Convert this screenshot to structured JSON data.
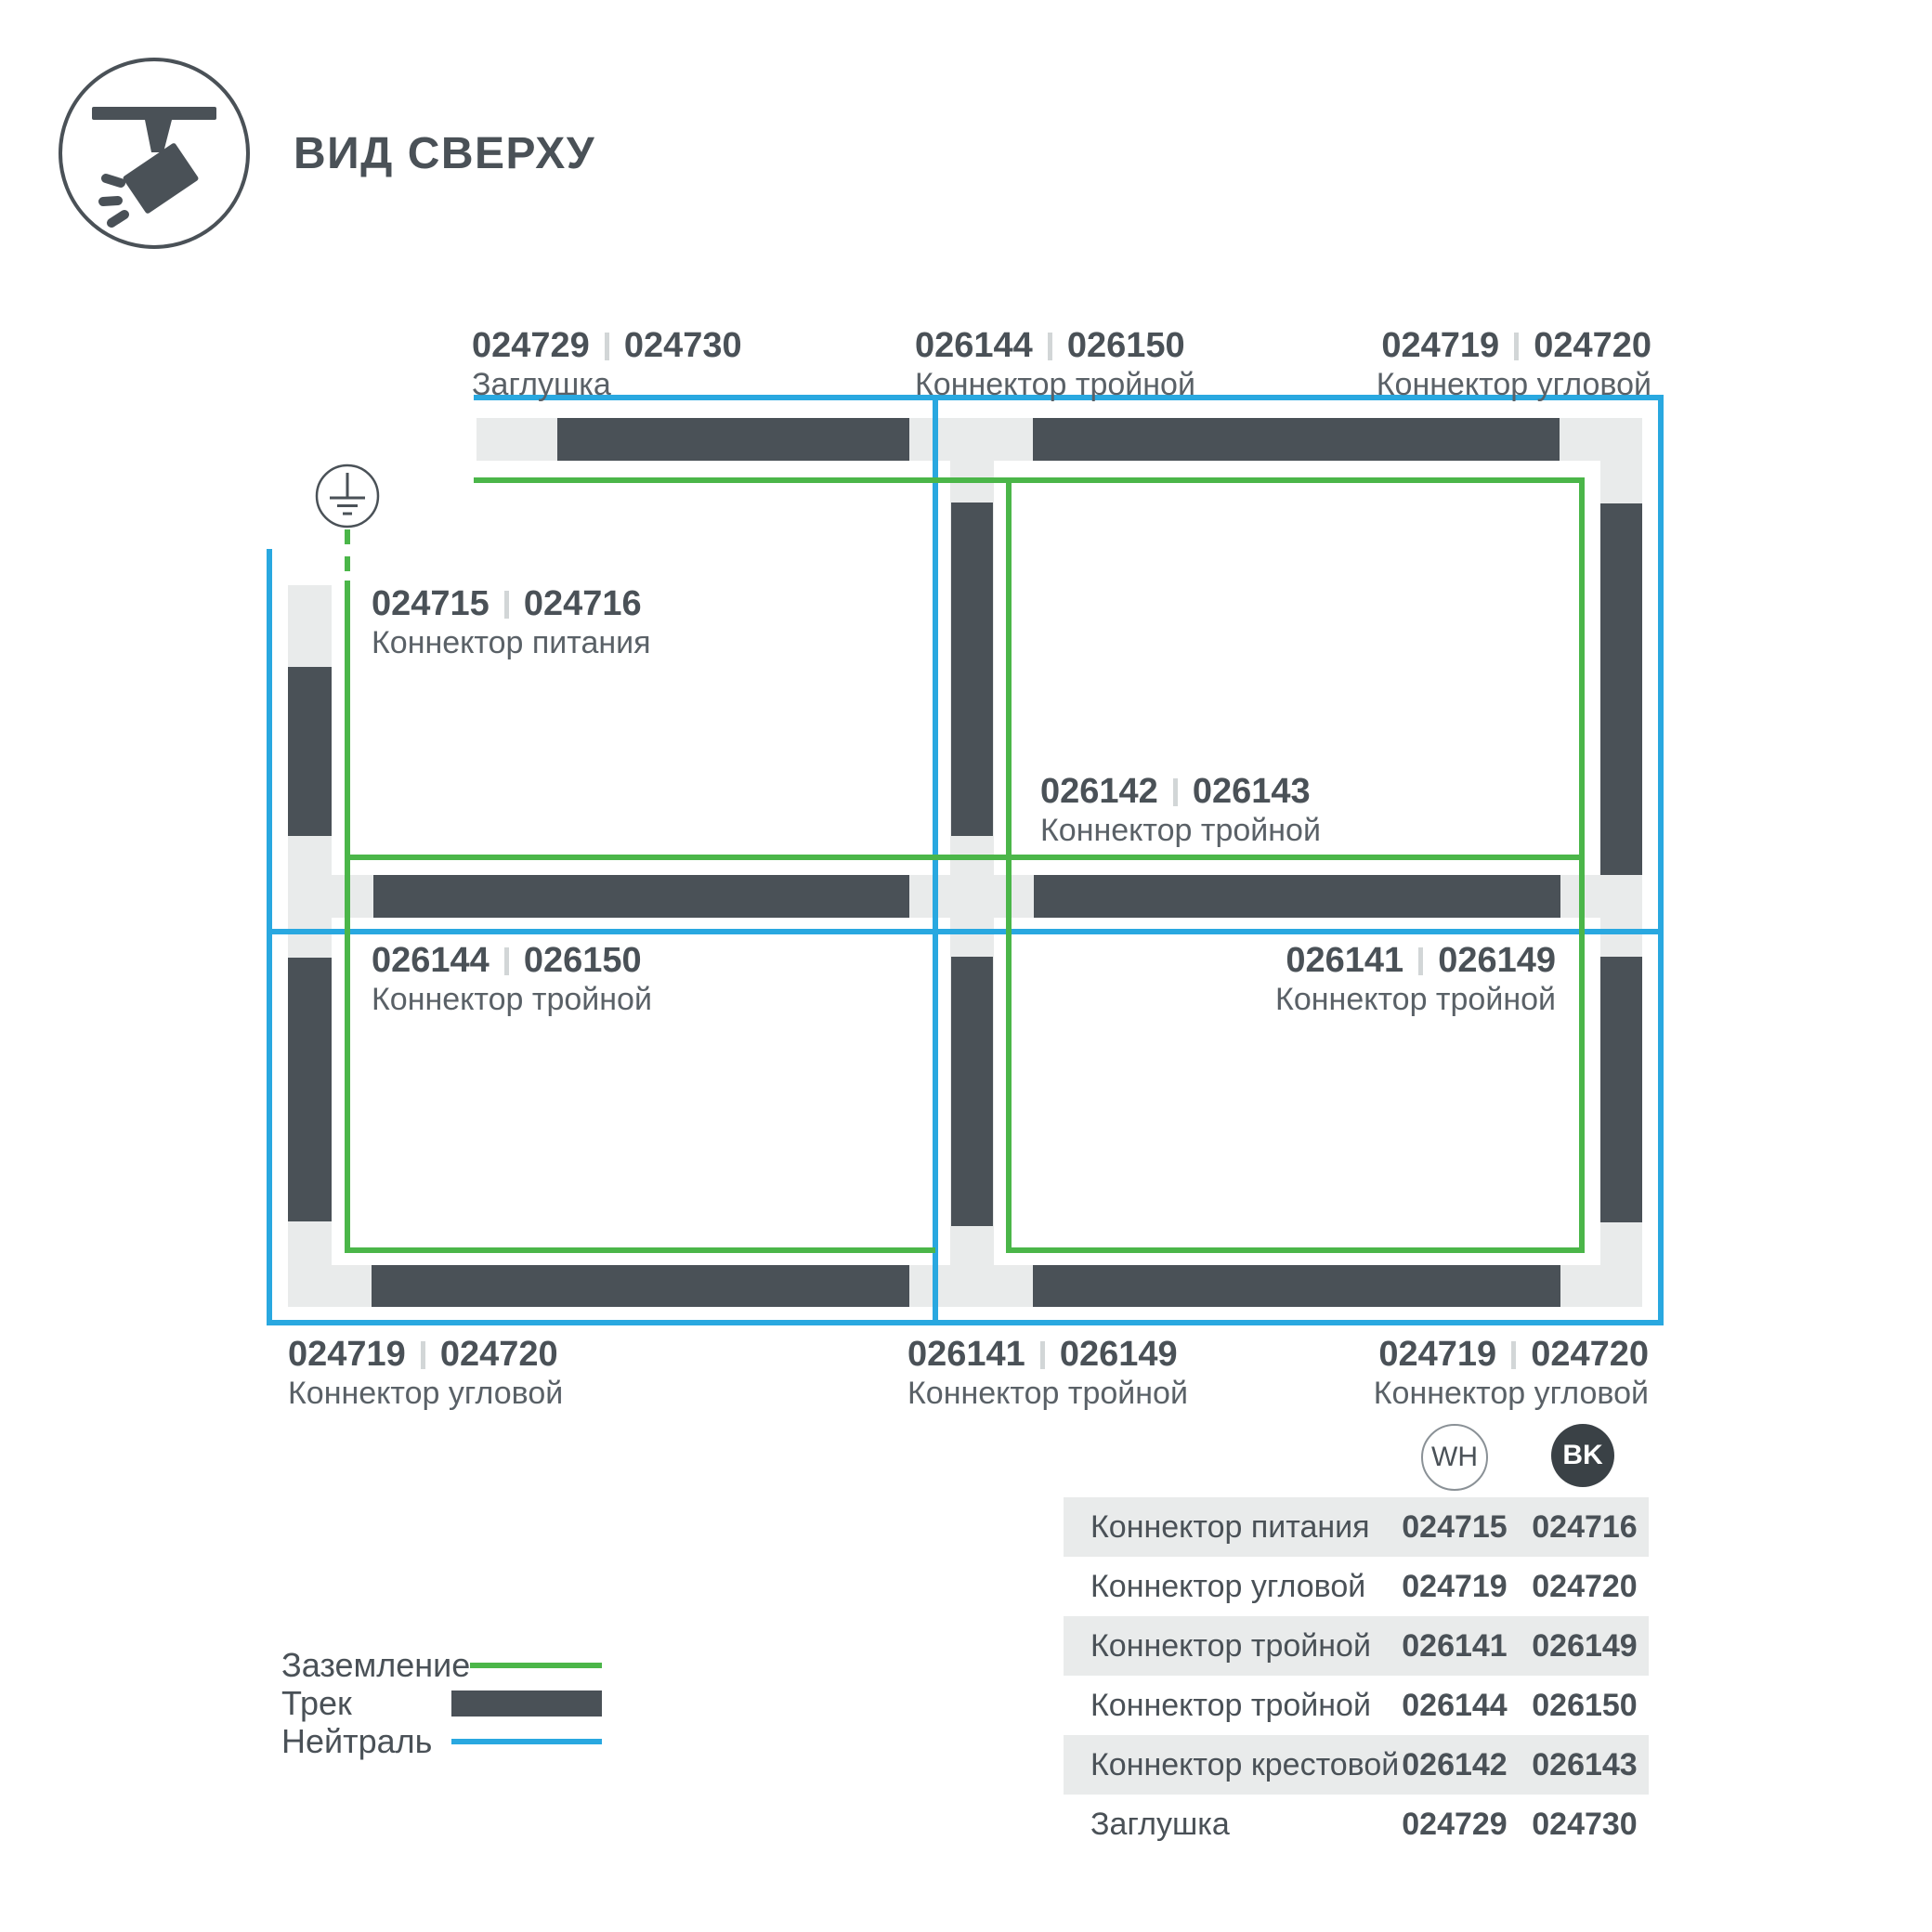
{
  "header": {
    "title": "ВИД СВЕРХУ"
  },
  "colors": {
    "track_dark": "#4A5157",
    "track_base": "#E9EBEB",
    "ground_green": "#4BB649",
    "neutral_blue": "#29A8E0",
    "text": "#4A5157",
    "table_row_gray": "#E9EBEB",
    "bk_badge": "#3A4146"
  },
  "diagram": {
    "labels": [
      {
        "num1": "024729",
        "num2": "024730",
        "caption": "Заглушка"
      },
      {
        "num1": "026144",
        "num2": "026150",
        "caption": "Коннектор тройной"
      },
      {
        "num1": "024719",
        "num2": "024720",
        "caption": "Коннектор угловой"
      },
      {
        "num1": "024715",
        "num2": "024716",
        "caption": "Коннектор питания"
      },
      {
        "num1": "026142",
        "num2": "026143",
        "caption": "Коннектор тройной"
      },
      {
        "num1": "026144",
        "num2": "026150",
        "caption": "Коннектор тройной"
      },
      {
        "num1": "026141",
        "num2": "026149",
        "caption": "Коннектор тройной"
      },
      {
        "num1": "024719",
        "num2": "024720",
        "caption": "Коннектор угловой"
      },
      {
        "num1": "026141",
        "num2": "026149",
        "caption": "Коннектор тройной"
      },
      {
        "num1": "024719",
        "num2": "024720",
        "caption": "Коннектор угловой"
      }
    ]
  },
  "legend": {
    "items": [
      {
        "label": "Заземление",
        "swatch": "ground-line"
      },
      {
        "label": "Трек",
        "swatch": "track-bar"
      },
      {
        "label": "Нейтраль",
        "swatch": "neutral-line"
      }
    ]
  },
  "table": {
    "col_wh": "WH",
    "col_bk": "BK",
    "rows": [
      {
        "name": "Коннектор питания",
        "wh": "024715",
        "bk": "024716"
      },
      {
        "name": "Коннектор угловой",
        "wh": "024719",
        "bk": "024720"
      },
      {
        "name": "Коннектор тройной",
        "wh": "026141",
        "bk": "026149"
      },
      {
        "name": "Коннектор тройной",
        "wh": "026144",
        "bk": "026150"
      },
      {
        "name": "Коннектор крестовой",
        "wh": "026142",
        "bk": "026143"
      },
      {
        "name": "Заглушка",
        "wh": "024729",
        "bk": "024730"
      }
    ]
  }
}
